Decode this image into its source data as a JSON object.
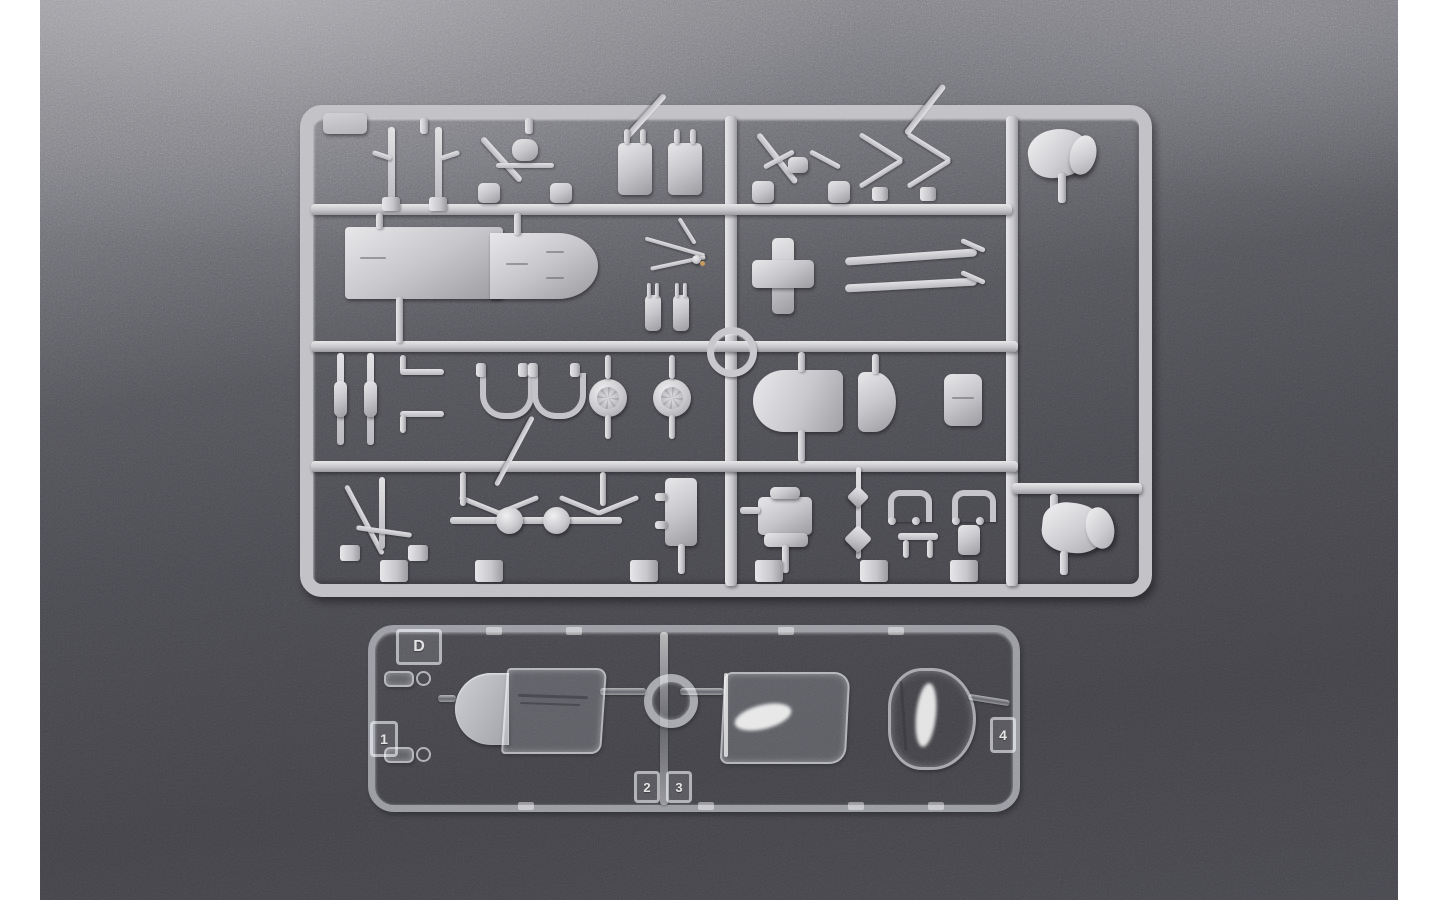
{
  "palette": {
    "backdrop": "#ffffff",
    "surface-top": "#929297",
    "surface-upper": "#75757b",
    "surface-mid": "#515157",
    "surface-dark": "#404045",
    "pl": "#c7c7cb",
    "pl-light": "#e7e7ea",
    "pl-dark": "#9b9ba0"
  },
  "scene": {
    "description": "Overhead photograph of two injection-molded model aircraft kit sprues lying on a dark speckled surface: a large light-gray styrene runner packed with small airframe parts, and a smaller clear runner below it holding three canopy sections.",
    "gray_sprue": {
      "label": "light gray styrene runner",
      "parts": [
        "landing gear struts",
        "canopy frame",
        "connector blocks",
        "support arch",
        "cross braces",
        "pilot seat",
        "fuselage deck section",
        "control linkage cluster",
        "pronged fittings",
        "cross-shaped mount",
        "wing struts",
        "oleo legs",
        "gear door yokes",
        "main wheels",
        "hoist ring",
        "engine cowling",
        "cowl flap section",
        "intake fairing",
        "gear leg tripod",
        "wheel linkage assembly",
        "junction block",
        "machine gun breech",
        "small fittings",
        "second pilot seat"
      ]
    },
    "clear_sprue": {
      "label": "clear canopy runner",
      "sprue_letter": "D",
      "part_numbers": [
        "1",
        "2",
        "3",
        "4"
      ],
      "parts": [
        "windscreen",
        "sliding canopy",
        "rear canopy section",
        "small lenses"
      ]
    }
  }
}
